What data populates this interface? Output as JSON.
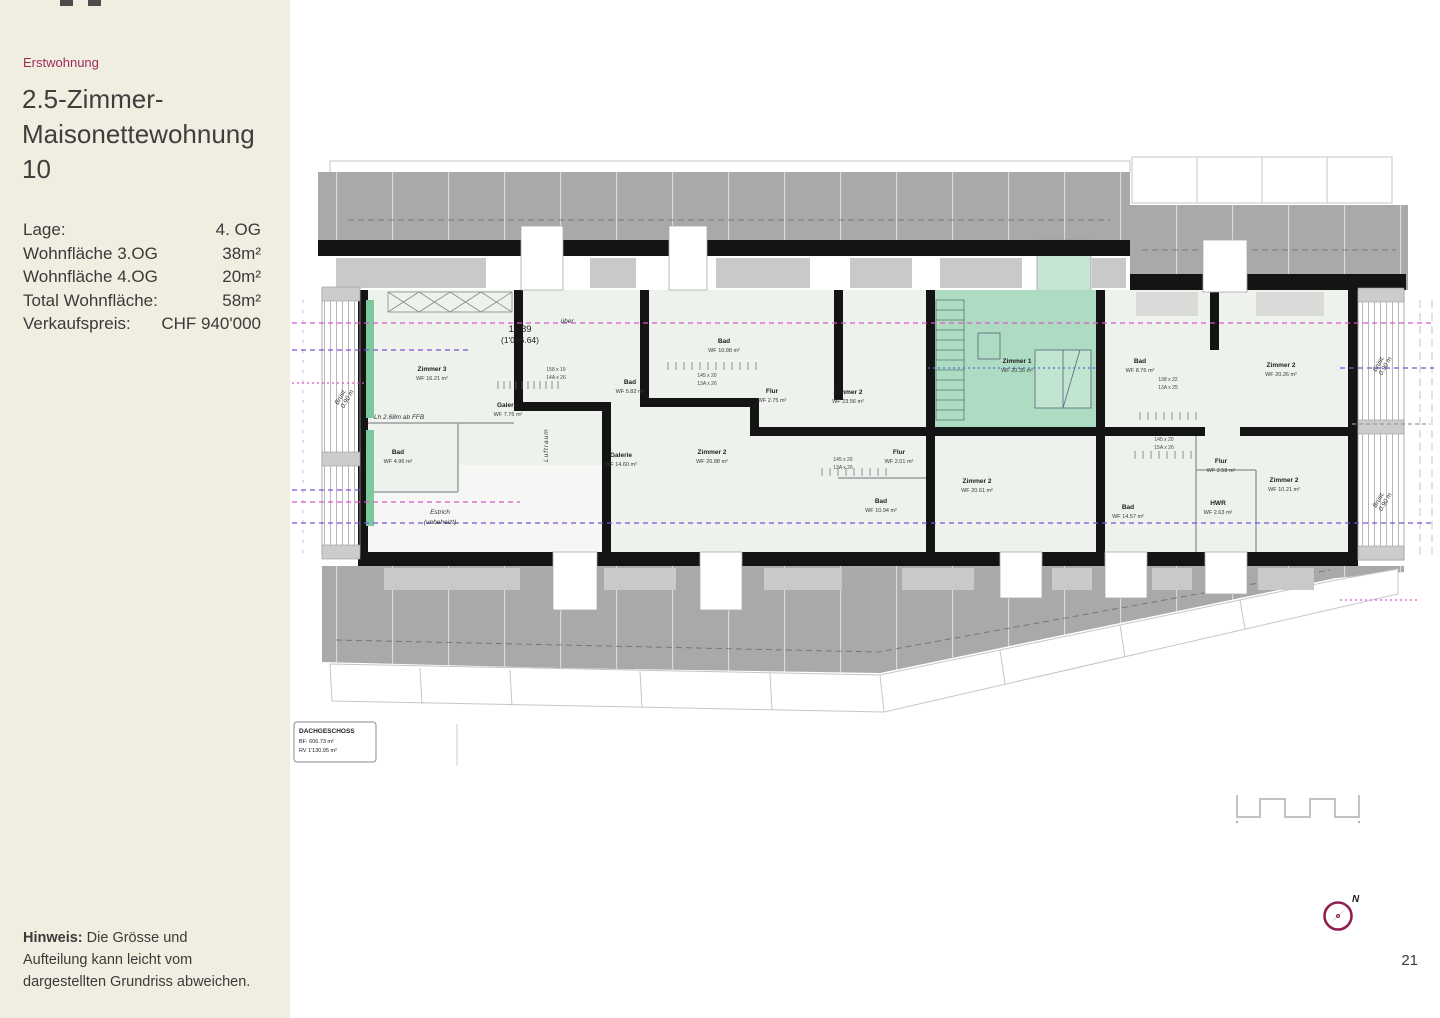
{
  "sidebar": {
    "category": "Erstwohnung",
    "title_line1": "2.5-Zimmer-",
    "title_line2": "Maisonettewohnung 10",
    "details": [
      {
        "label": "Lage:",
        "value": "4. OG"
      },
      {
        "label": "Wohnfläche 3.OG",
        "value": "38m²"
      },
      {
        "label": "Wohnfläche 4.OG",
        "value": "20m²"
      },
      {
        "label": "Total Wohnfläche:",
        "value": "58m²"
      },
      {
        "label": "Verkaufspreis:",
        "value": "CHF 940'000"
      }
    ],
    "note_bold": "Hinweis:",
    "note_rest": "Die Grösse und Aufteilung kann leicht vom dargestellten Grundriss abweichen."
  },
  "plan": {
    "info_box": {
      "title": "DACHGESCHOSS",
      "bf": "BF:  606.73 m²",
      "rv": "RV 1'130.95 m²"
    },
    "elevation": {
      "value": "11.89",
      "ref": "(1'095.64)"
    },
    "annotations": {
      "over": "über",
      "height_note": "Lh 2.68m ab FFB",
      "estrich": "Estrich",
      "estrich_sub": "(unbeheizt)",
      "luftraum": "Luftraum",
      "parapet_l1": "Brüst.",
      "parapet_l2": "0.90 m"
    },
    "rooms": [
      {
        "name": "Zimmer 3",
        "area": "WF 16.21 m²"
      },
      {
        "name": "Galerie",
        "area": "WF 7.76 m²"
      },
      {
        "name": "Bad",
        "area": "WF 4.96 m²"
      },
      {
        "name": "Bad",
        "area": "WF 5.82 m²"
      },
      {
        "name": "Galerie",
        "area": "WF 14.60 m²"
      },
      {
        "name": "Bad",
        "area": "WF 10.98 m²"
      },
      {
        "name": "Flur",
        "area": "WF 2.75 m²"
      },
      {
        "name": "Zimmer 2",
        "area": "WF 20.88 m²"
      },
      {
        "name": "Zimmer 2",
        "area": "WF 23.56 m²"
      },
      {
        "name": "Flur",
        "area": "WF 2.01 m²"
      },
      {
        "name": "Bad",
        "area": "WF 10.94 m²"
      },
      {
        "name": "Zimmer 2",
        "area": "WF 20.61 m²"
      },
      {
        "name": "Zimmer 1",
        "area": "WF 20.35 m²"
      },
      {
        "name": "Bad",
        "area": "WF 8.76 m²"
      },
      {
        "name": "Zimmer 2",
        "area": "WF 20.26 m²"
      },
      {
        "name": "Flur",
        "area": "WF 2.58 m²"
      },
      {
        "name": "Zimmer 2",
        "area": "WF 10.21 m²"
      },
      {
        "name": "HWR",
        "area": "WF 2.63 m²"
      },
      {
        "name": "Bad",
        "area": "WF 14.57 m²"
      }
    ],
    "stairs": [
      {
        "l1": "158 x 19",
        "l2": "14A x 26"
      },
      {
        "l1": "145 x 20",
        "l2": "13A x 26"
      },
      {
        "l1": "145 x 20",
        "l2": "13A x 26"
      },
      {
        "l1": "138 x 22",
        "l2": "13A x 25"
      },
      {
        "l1": "145 x 20",
        "l2": "15A x 26"
      }
    ]
  },
  "compass": {
    "north_label": "N"
  },
  "page_number": "21",
  "colors": {
    "sidebar_bg": "#f0eee1",
    "accent": "#9e2a5a",
    "highlight_room": "#aedcc2",
    "roof_gray": "#a9a9a9",
    "section_pink": "#dd55cc",
    "section_purple": "#7d4fd8"
  }
}
